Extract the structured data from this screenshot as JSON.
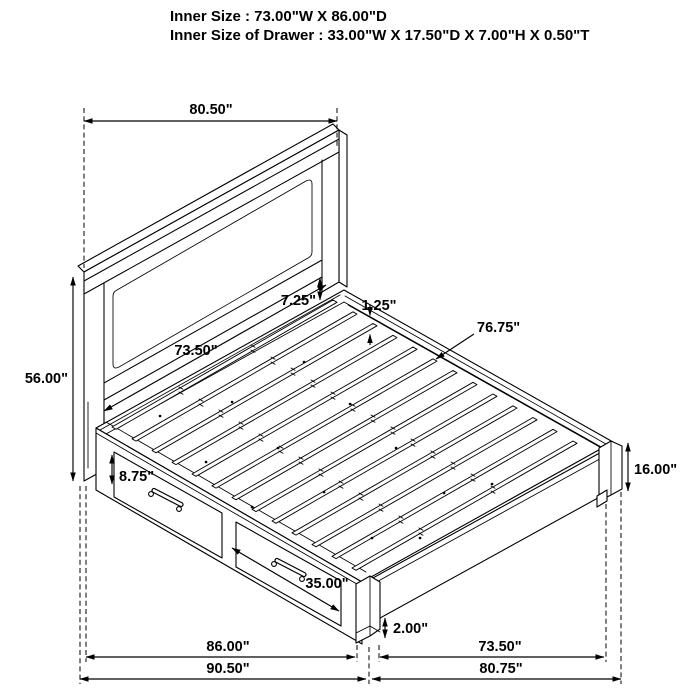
{
  "header": {
    "line1": "Inner Size : 73.00\"W X 86.00\"D",
    "line2": "Inner Size of Drawer : 33.00\"W X 17.50\"D X 7.00\"H X 0.50\"T"
  },
  "dimensions": {
    "headboard_width": "80.50\"",
    "overall_height": "56.00\"",
    "headboard_inner_width": "73.50\"",
    "headboard_panel_gap": "7.25\"",
    "slat_thickness": "1.25\"",
    "slat_length": "76.75\"",
    "side_rail_top_height": "8.75\"",
    "drawer_front_width": "35.00\"",
    "footboard_height": "16.00\"",
    "ground_clearance": "2.00\"",
    "inner_depth": "86.00\"",
    "outer_depth": "90.50\"",
    "footboard_inner_width": "73.50\"",
    "footboard_outer_width": "80.75\""
  }
}
